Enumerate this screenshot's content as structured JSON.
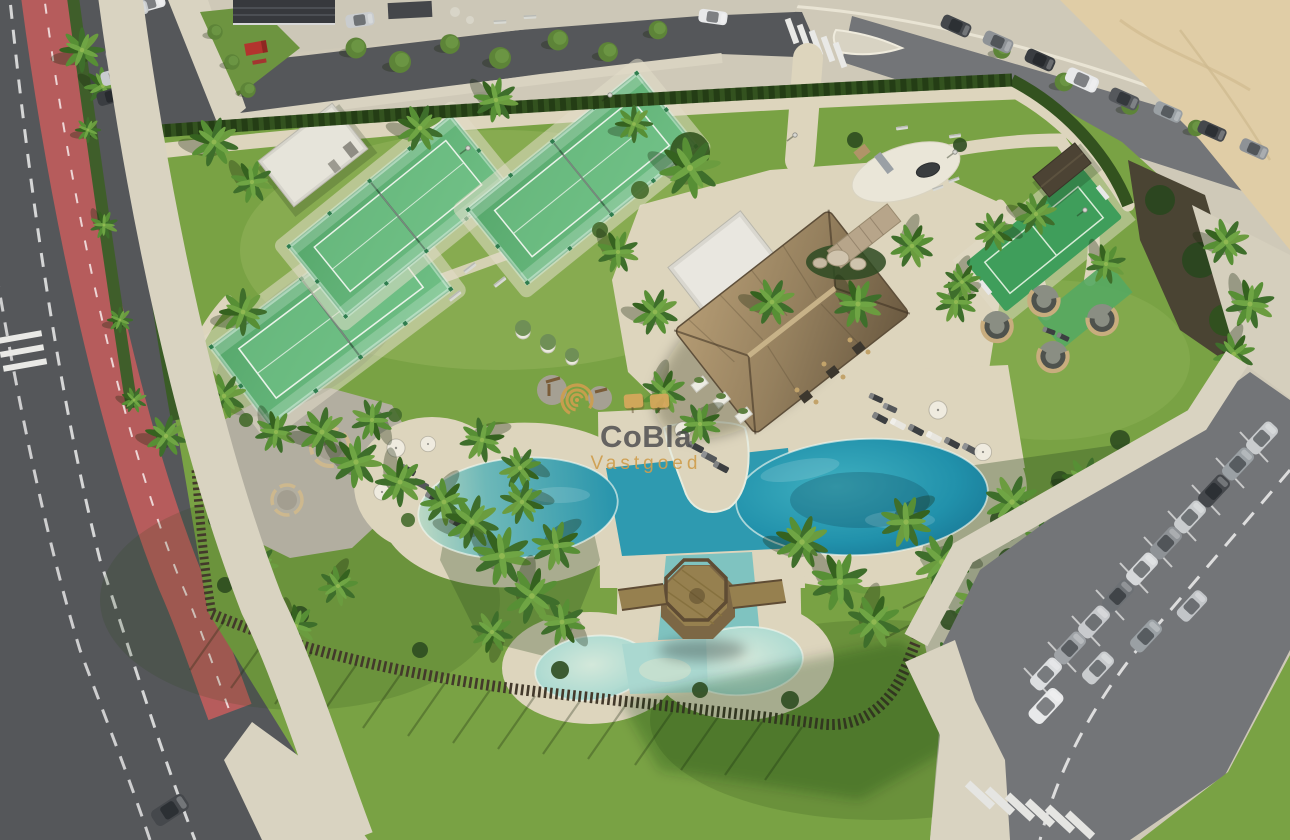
{
  "watermark": {
    "title": "CoBla",
    "subtitle": "Vastgoed",
    "logo": "spiral-logo",
    "title_color": "#4b4b4d",
    "subtitle_color": "#cf9e4e",
    "logo_color": "#c89a4b",
    "parasol_color": "#d8a85c"
  },
  "palette": {
    "grass": "#79a244",
    "grassLight": "#8db554",
    "deck": "#ddd5bd",
    "deckLight": "#e8e1cc",
    "gravel": "#b2aea0",
    "sandBeach": "#e0cda6",
    "asphalt": "#55575a",
    "asphaltLight": "#737578",
    "bikeLane": "#b65c5c",
    "sidewalk": "#d9d3c1",
    "hedge": "#33521f",
    "fenceWood": "#43392b",
    "poolDeep": "#1f82a2",
    "poolMid": "#2e9ab0",
    "kidsPool": "#a5d6cf",
    "channel": "#7fc3c0",
    "thatch": "#95805e",
    "annexRoof": "#e9e7e0",
    "padelTurf": "#4fa065",
    "padelFrame": "#2f7d4e",
    "multisport": "#3f9e5b",
    "playgroundPad": "#eae6d8",
    "woodDeck": "#96804f",
    "woodRail": "#5f4c34",
    "podWood": "#c8ad7e",
    "stoneWall": "#b7a58a",
    "carDark": "#45484c",
    "carGray": "#9aa0a4",
    "carSilver": "#c9ccce",
    "carWhite": "#e8e9ea",
    "truckRed": "#b3342e",
    "lineWhite": "#ececec",
    "wmTitle": "#4b4b4d",
    "wmGold": "#cf9e4e",
    "wmParasol": "#d8a85c"
  },
  "scene": {
    "type": "aerial-render-of-resort-amenity-area",
    "objects": [
      "left-road",
      "bike-lane",
      "sidewalk",
      "top-road",
      "beach-road",
      "beach-sand",
      "street-building",
      "service-parking",
      "red-truck",
      "property-lawn",
      "perimeter-hedge",
      "wooden-fence",
      "storage-building",
      "padel-court",
      "multisport-court",
      "playground",
      "garden-shelter",
      "seating-pods",
      "picnic-grove",
      "fitness-area",
      "pool-pavilion",
      "pavilion-annex",
      "stone-wall-feature",
      "main-pool",
      "kids-pool",
      "pool-channel",
      "gazebo-deck",
      "gazebo-bridge",
      "sun-loungers",
      "parasols",
      "palm-trees",
      "street-trees",
      "right-parking",
      "parked-cars",
      "crosswalks",
      "road-markings",
      "watermark"
    ]
  }
}
